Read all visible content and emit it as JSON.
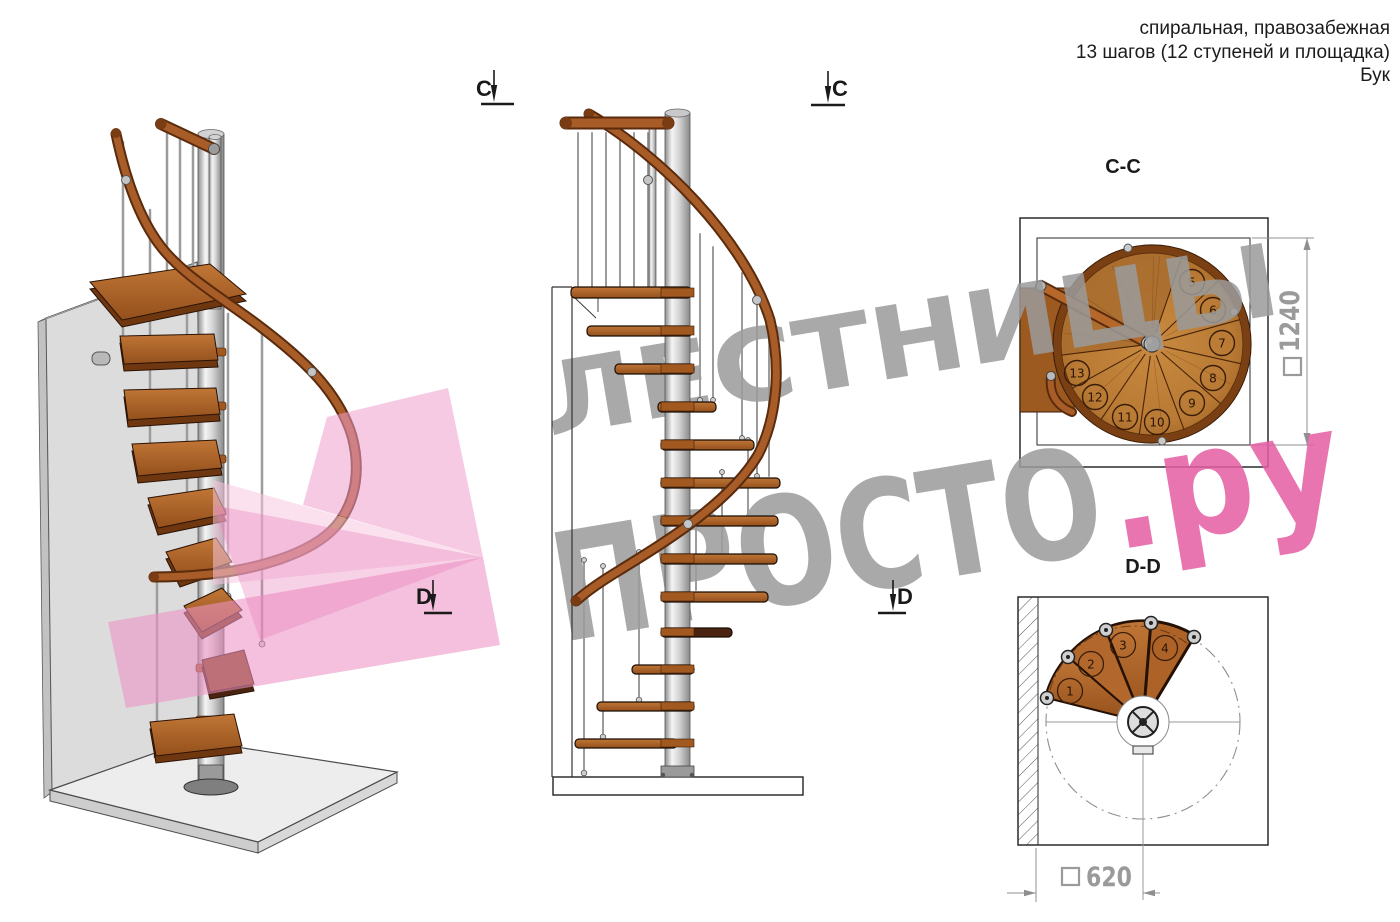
{
  "header": {
    "line1": "спиральная, правозабежная",
    "line2": "13 шагов (12 ступеней и площадка)",
    "line3": "Бук"
  },
  "watermark": {
    "line1": "ЛЕСТНИЦЫ",
    "line2_gray": "ПРОСТО",
    "line2_accent": ".ру",
    "gray_color": "#9b9b9b",
    "accent_color": "#e55ea2",
    "ribbon_pink": "#ee92c4"
  },
  "markers": {
    "c": "C",
    "d": "D"
  },
  "views": {
    "section_cc": {
      "label": "C-C",
      "dimension": {
        "square": "□",
        "value": "1240"
      },
      "step_numbers": [
        "5",
        "6",
        "7",
        "8",
        "9",
        "10",
        "11",
        "12",
        "13"
      ]
    },
    "section_dd": {
      "label": "D-D",
      "dimension": {
        "square": "□",
        "value": "620"
      },
      "step_numbers": [
        "1",
        "2",
        "3",
        "4"
      ]
    }
  },
  "colors": {
    "wood_mid": "#b5682a",
    "wood_dark": "#7a3c12",
    "wood_outline": "#2a1205",
    "metal_light": "#e8e8e8",
    "metal_dark": "#8a8a8a",
    "wall_gray": "#dcdcdc",
    "dim_gray": "#9a9a9a",
    "line_dark": "#2a2a2a"
  }
}
